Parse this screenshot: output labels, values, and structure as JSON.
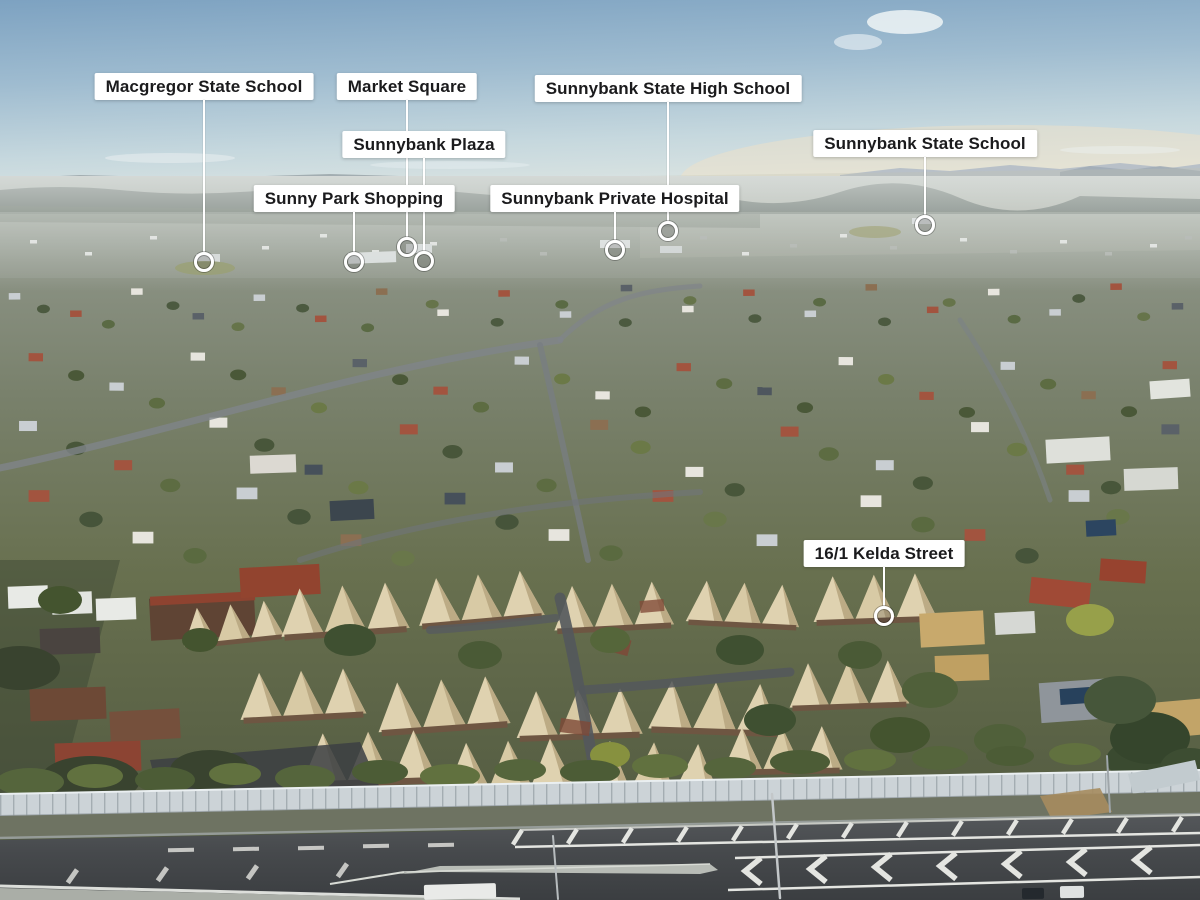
{
  "annotations": [
    {
      "id": "macgregor-state-school",
      "label": "Macgregor State School"
    },
    {
      "id": "market-square",
      "label": "Market Square"
    },
    {
      "id": "sunnybank-state-high-school",
      "label": "Sunnybank State High School"
    },
    {
      "id": "sunnybank-plaza",
      "label": "Sunnybank Plaza"
    },
    {
      "id": "sunnybank-state-school",
      "label": "Sunnybank State School"
    },
    {
      "id": "sunny-park-shopping",
      "label": "Sunny Park Shopping"
    },
    {
      "id": "sunnybank-private-hospital",
      "label": "Sunnybank Private Hospital"
    },
    {
      "id": "property-16-1-kelda-street",
      "label": "16/1 Kelda Street"
    }
  ],
  "overlay": {
    "label_bg": "#ffffff",
    "label_text": "#1b1b1d",
    "line_color": "#ffffff",
    "marker_color": "#ffffff"
  }
}
